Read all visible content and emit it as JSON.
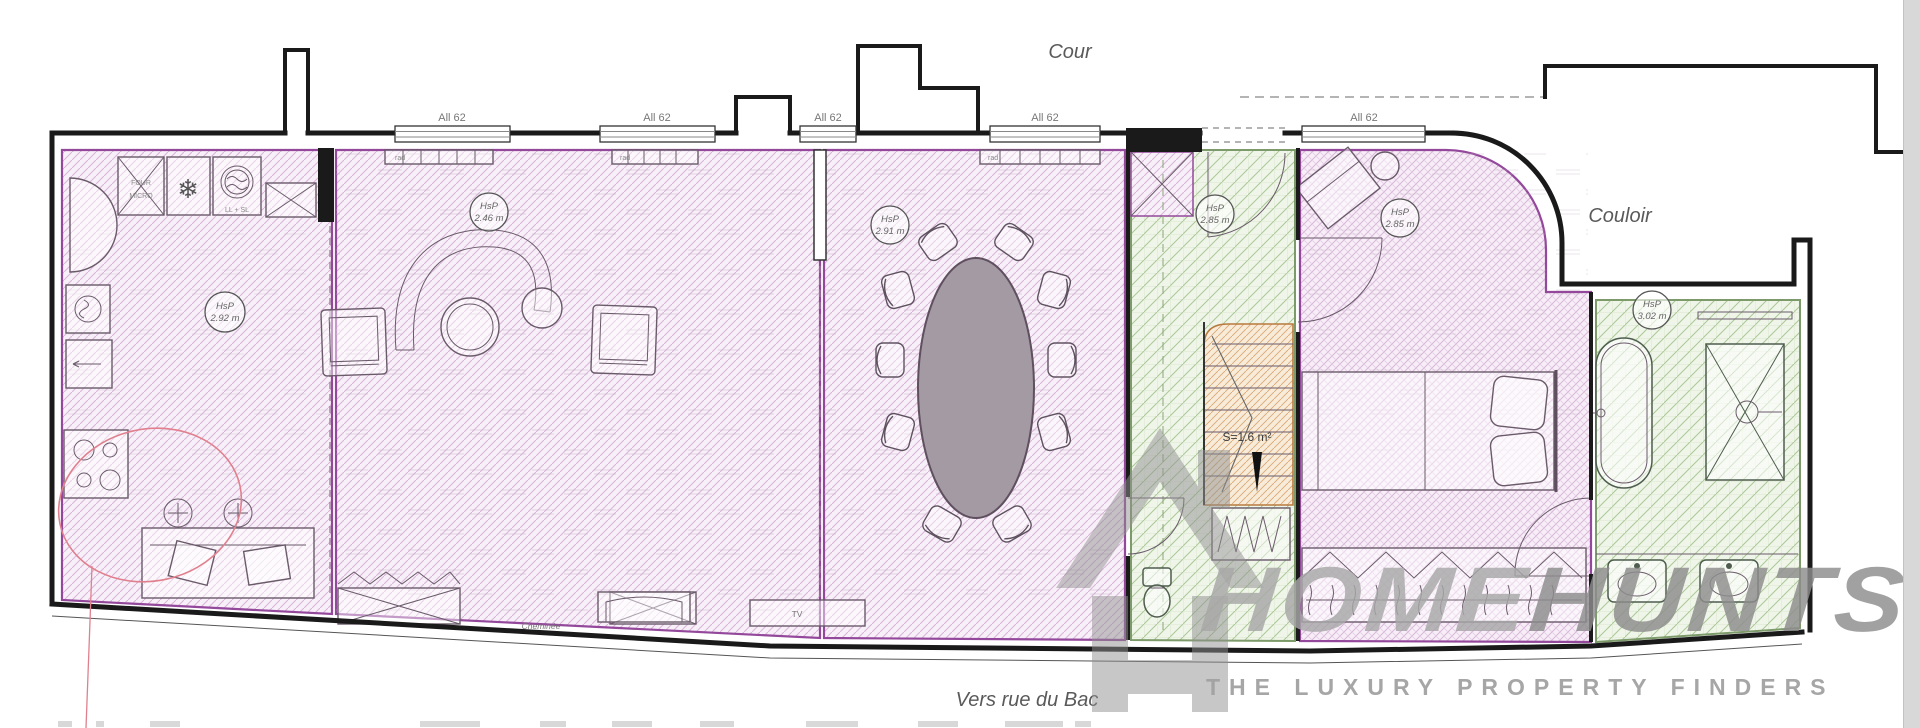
{
  "plan": {
    "area_labels": {
      "courtyard": "Cour",
      "corridor": "Couloir",
      "street_direction": "Vers rue du Bac"
    },
    "windows": [
      {
        "label": "All 62"
      },
      {
        "label": "All 62"
      },
      {
        "label": "All 62"
      },
      {
        "label": "All 62"
      },
      {
        "label": "All 62"
      }
    ],
    "ceiling_heights": [
      {
        "room": "kitchen",
        "label": "HsP",
        "value": "2.92 m"
      },
      {
        "room": "living-room",
        "label": "HsP",
        "value": "2.46 m"
      },
      {
        "room": "dining-room",
        "label": "HsP",
        "value": "2.91 m"
      },
      {
        "room": "entrance-hall",
        "label": "HsP",
        "value": "2.85 m"
      },
      {
        "room": "bedroom",
        "label": "HsP",
        "value": "2.85 m"
      },
      {
        "room": "bathroom",
        "label": "HsP",
        "value": "3.02 m"
      }
    ],
    "stairs": {
      "area_label": "S=1.6 m²"
    },
    "kitchen": {
      "oven_label_line1": "FOUR",
      "oven_label_line2": "MICRO",
      "washer_dryer_label": "LL + SL",
      "fridge_icon": "❄"
    },
    "living_room": {
      "fireplace_label": "Cheminée",
      "tv_label": "TV",
      "radiator_label": "rad"
    }
  },
  "logo": {
    "brand_first": "HOME",
    "brand_second": "HUNTS",
    "tagline": "THE LUXURY PROPERTY FINDERS"
  },
  "colors": {
    "pink_hatch": "#d8b6d8",
    "green_hatch": "#abc898",
    "stairs_hatch": "#d9a976",
    "wall": "#1a1a1a",
    "dining_table_fill": "#a39aa3",
    "red_annotation": "#e0808f",
    "logo_gray": "#9c9c9c"
  }
}
